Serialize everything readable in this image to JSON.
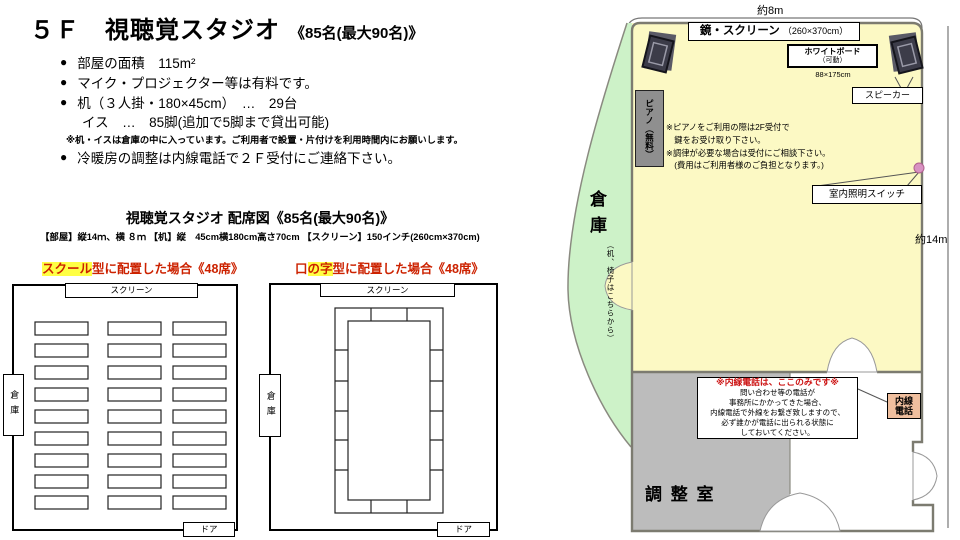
{
  "header": {
    "title": "５Ｆ　視聴覚スタジオ",
    "capacity": "《85名(最大90名)》",
    "bullet1": "部屋の面積　115m²",
    "bullet2": "マイク・プロジェクター等は有料です。",
    "bullet3": "机（３人掛・180×45cm）　…　29台",
    "bullet3b": "イス　…　85脚(追加で5脚まで貸出可能)",
    "note": "※机・イスは倉庫の中に入っています。ご利用者で設置・片付けを利用時間内にお願いします。",
    "bullet4": "冷暖房の調整は内線電話で２Ｆ受付にご連絡下さい。"
  },
  "seating": {
    "title": "視聴覚スタジオ 配席図《85名(最大90名)》",
    "specs": "【部屋】縦14ｍ、横 ８ｍ 【机】縦　45cm横180cm高さ70cm 【スクリーン】150インチ(260cm×370cm)",
    "school_highlight": "スクール",
    "school_rest": "型に配置した場合《48席》",
    "square_pre": "口",
    "square_highlight": "の字",
    "square_rest": "型に配置した場合《48席》",
    "screen": "スクリーン",
    "storage": "倉庫",
    "door": "ドア"
  },
  "floorplan": {
    "width_dim": "約8m",
    "height_dim": "約14m",
    "mirror_screen": "鏡・スクリーン",
    "mirror_screen_size": "（260×370cm）",
    "whiteboard": "ホワイトボード",
    "whiteboard_sub": "（可動）",
    "whiteboard_size": "88×175cm",
    "speaker": "スピーカー",
    "piano": "ピアノ（無料）",
    "piano_note1": "※ピアノをご利用の際は2F受付で",
    "piano_note2": "　鍵をお受け取り下さい。",
    "piano_note3": "※調律が必要な場合は受付にご相談下さい。",
    "piano_note4": "　(費用はご利用者様のご負担となります。)",
    "light_switch": "室内照明スイッチ",
    "storage": "倉庫",
    "storage_sub": "（机、椅子はこちらから）",
    "control_room": "調 整 室",
    "phone_title": "※内線電話は、ここのみです※",
    "phone_line1": "問い合わせ等の電話が",
    "phone_line2": "事務所にかかってきた場合、",
    "phone_line3": "内線電話で外線をお繋ぎ致しますので、",
    "phone_line4": "必ず誰かが電話に出られる状態に",
    "phone_line5": "しておいてください。",
    "phone_box1": "内線",
    "phone_box2": "電話"
  },
  "colors": {
    "room_fill": "#fcf9c4",
    "storage_fill": "#cdf2c8",
    "control_fill": "#bcbcbc",
    "highlight": "#ffff44",
    "heading_red": "#cc2200",
    "phone_box_fill": "#f0bf9e",
    "switch_dot": "#d892c2"
  }
}
